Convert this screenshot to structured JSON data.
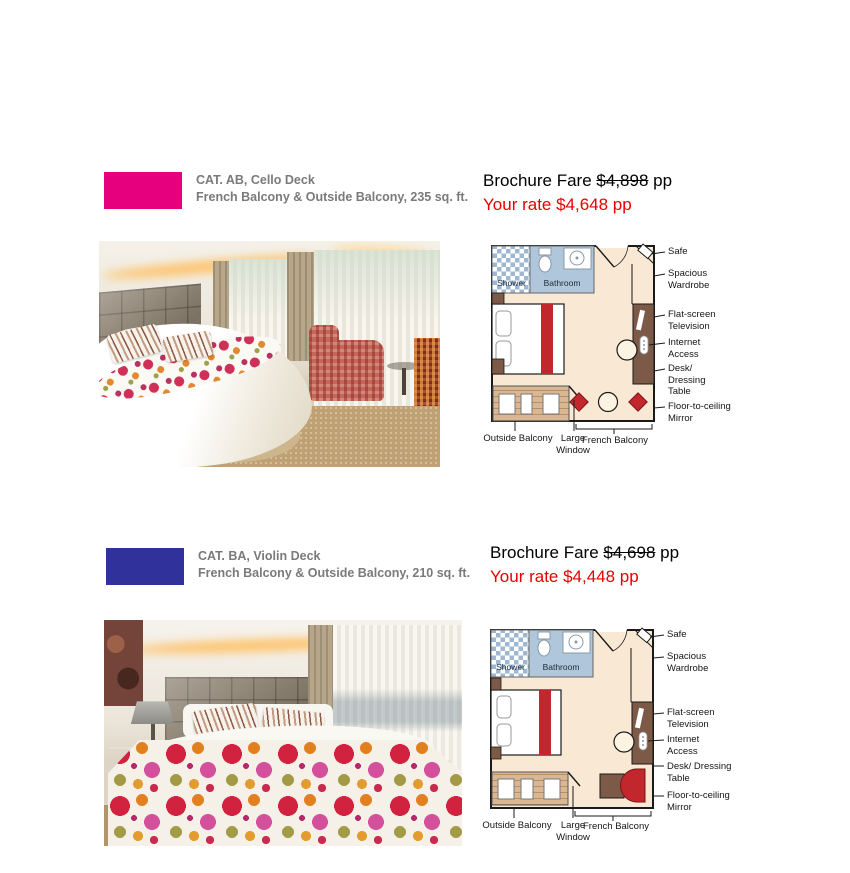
{
  "colors": {
    "cat_ab_swatch": "#e6007e",
    "cat_ba_swatch": "#31319b",
    "rate_red": "#e60000",
    "header_gray": "#7a7a7a"
  },
  "sections": [
    {
      "category_title": "CAT. AB, Cello Deck",
      "category_subtitle": "French Balcony & Outside Balcony, 235 sq. ft.",
      "swatch_color": "#e6007e",
      "fare_label": "Brochure Fare",
      "fare_old": "$4,898",
      "fare_unit": "pp",
      "your_rate": "Your rate $4,648 pp",
      "plan": {
        "room_labels": {
          "shower": "Shower",
          "bathroom": "Bathroom"
        },
        "right_labels": [
          "Safe",
          "Spacious Wardrobe",
          "Flat-screen Television",
          "Internet Access",
          "Desk/ Dressing Table",
          "Floor-to-ceiling Mirror"
        ],
        "bottom_labels": [
          "Outside Balcony",
          "Large Window",
          "French Balcony"
        ]
      }
    },
    {
      "category_title": "CAT. BA, Violin Deck",
      "category_subtitle": "French Balcony & Outside Balcony, 210 sq. ft.",
      "swatch_color": "#31319b",
      "fare_label": "Brochure Fare",
      "fare_old": "$4,698",
      "fare_unit": "pp",
      "your_rate": "Your rate $4,448 pp",
      "plan": {
        "room_labels": {
          "shower": "Shower",
          "bathroom": "Bathroom"
        },
        "right_labels": [
          "Safe",
          "Spacious Wardrobe",
          "Flat-screen Television",
          "Internet Access",
          "Desk/ Dressing Table",
          "Floor-to-ceiling Mirror"
        ],
        "bottom_labels": [
          "Outside Balcony",
          "Large Window",
          "French Balcony"
        ]
      }
    }
  ]
}
